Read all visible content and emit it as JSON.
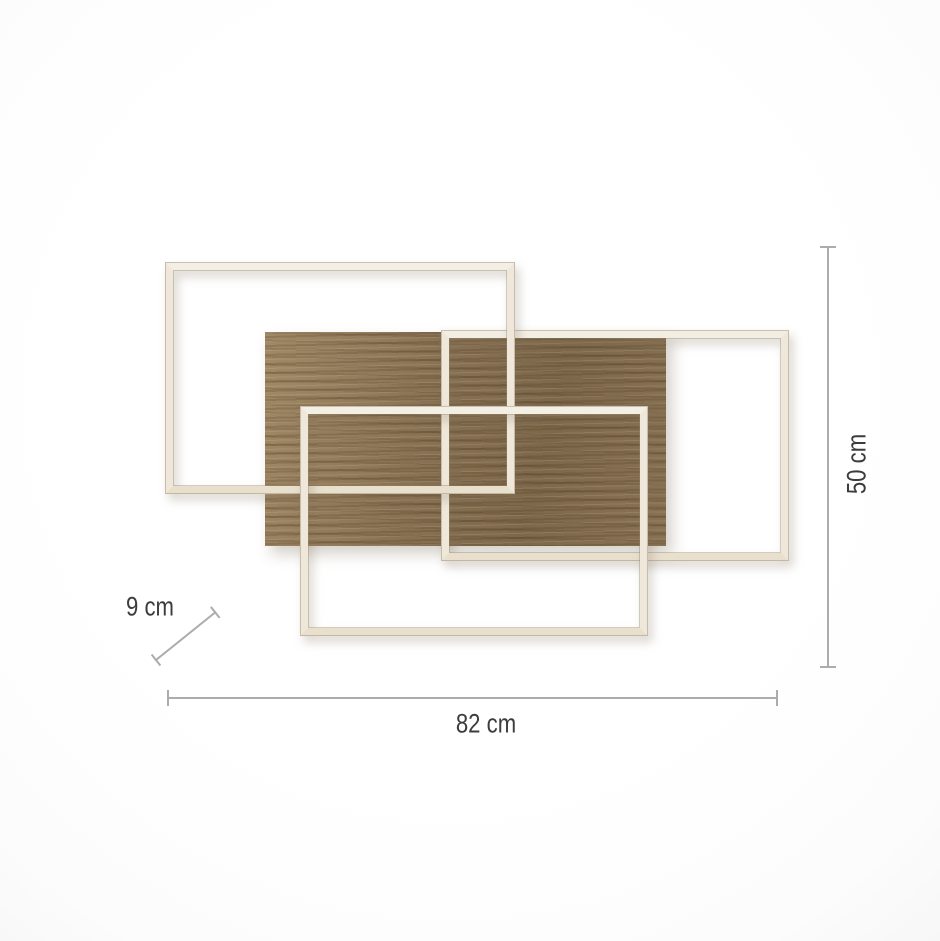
{
  "diagram": {
    "type": "product-dimension-diagram",
    "subject": "wall-ceiling-light-with-wood-panel-and-three-frames",
    "dimensions": {
      "width_label": "82 cm",
      "height_label": "50 cm",
      "depth_label": "9 cm"
    },
    "elements": [
      "wood-panel",
      "frame-top-left",
      "frame-top-right",
      "frame-bottom"
    ]
  },
  "colors": {
    "frame": "#efe8da",
    "frame_edge": "#d9d0bf",
    "wood_base": "#8a7354",
    "wood_dark": "#6f5a3f",
    "wood_light": "#a38a66",
    "measure_line": "#acacb0",
    "measure_text": "#3c3c3e",
    "background": "#ffffff"
  }
}
